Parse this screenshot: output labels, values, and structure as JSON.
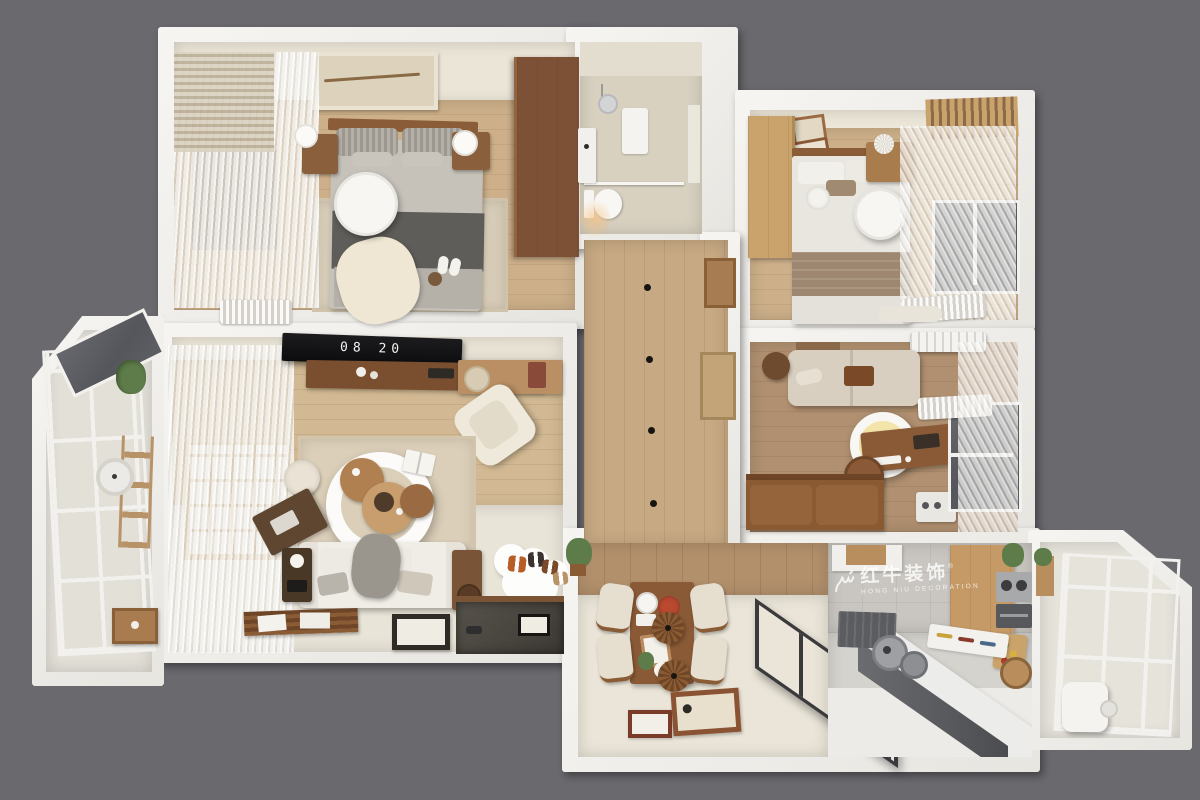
{
  "scene": {
    "description": "3D top-down dollhouse render of a two-bedroom apartment floor plan",
    "background_color": "#6a696e",
    "wall_color": "#f2f1ee"
  },
  "watermark": {
    "logo": "bull-swoosh-icon",
    "registered": "®",
    "title": "红牛装饰",
    "subtitle": "HONG NIU DECORATION"
  },
  "living_room_tv": {
    "clock_display": "08 20"
  },
  "palette": {
    "hall_wood": "#c7a983",
    "bedroom_wood": "#cdb08a",
    "study_wood": "#b09070",
    "dining_tile": "#eae5d8",
    "kitchen_tile": "#d0cec9",
    "bath_tile": "#d8d1c0",
    "walnut": "#7d5136",
    "oak": "#c9a26c",
    "glass": "#5e5f64",
    "sofa_fabric": "#efece5",
    "dark_blanket": "#5f5d59"
  },
  "rooms": [
    {
      "name": "master-bedroom",
      "contents": [
        "double-bed",
        "pendant-disc-lamp",
        "two-nightstands",
        "wardrobe",
        "rug",
        "radiator",
        "sheer-curtains",
        "wall-art",
        "slippers"
      ]
    },
    {
      "name": "bathroom",
      "contents": [
        "shower",
        "shower-mat",
        "toilet",
        "vanity",
        "window"
      ]
    },
    {
      "name": "second-bedroom",
      "contents": [
        "double-bed",
        "oak-wardrobe",
        "console",
        "pendant-disc-lamp",
        "picture-frames",
        "curtains",
        "window",
        "radiator",
        "bench"
      ]
    },
    {
      "name": "study",
      "contents": [
        "sofa",
        "round-ceiling-lamp",
        "desk",
        "office-chair",
        "leather-daybed",
        "air-conditioner",
        "side-table",
        "window",
        "radiator",
        "audio-shelf"
      ]
    },
    {
      "name": "living-room",
      "contents": [
        "wall-tv-clock",
        "media-console",
        "shelf",
        "armchair",
        "ring-ceiling-lamp",
        "nesting-coffee-tables",
        "rug",
        "pouf",
        "writing-desk",
        "sofa",
        "side-table",
        "speaker-cabinet",
        "slat-bench",
        "floor-frame",
        "cloud-shoe-mat",
        "entry-recess",
        "shoji-window",
        "sheer-curtains"
      ]
    },
    {
      "name": "hallway",
      "contents": [
        "wood-floor",
        "four-downlights",
        "door-niches"
      ]
    },
    {
      "name": "dining-room",
      "contents": [
        "dining-table",
        "four-chairs",
        "two-wood-pendants",
        "pizza-plate",
        "floor-picture-frames",
        "plant",
        "glass-partition"
      ]
    },
    {
      "name": "kitchen",
      "contents": [
        "upper-cabinets",
        "stove-and-oven",
        "range-hood",
        "duct",
        "pots",
        "utensil-tray",
        "cutting-board",
        "rattan-basket",
        "white-counter"
      ]
    },
    {
      "name": "west-balcony",
      "contents": [
        "angled-glazing",
        "ladder-shelf",
        "hanging-plant",
        "wall-clock",
        "planter-crate"
      ]
    },
    {
      "name": "south-balcony",
      "contents": [
        "glazing",
        "water-heater",
        "plant-shelf"
      ]
    }
  ]
}
